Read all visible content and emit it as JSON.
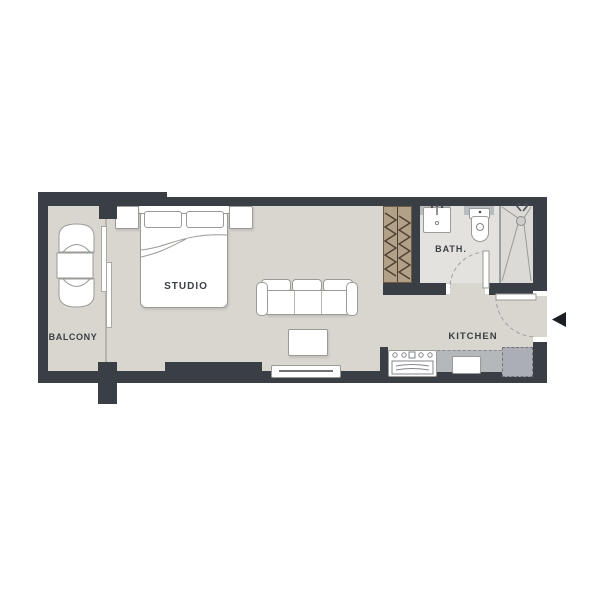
{
  "title": "Studio apartment floor plan",
  "labels": {
    "studio": "STUDIO",
    "balcony": "BALCONY",
    "bath": "BATH.",
    "kitchen": "KITCHEN"
  },
  "entrance": {
    "arrow_direction": "left",
    "side": "right-wall"
  },
  "rooms": [
    {
      "name": "STUDIO",
      "furniture": [
        "double-bed",
        "nightstand-left",
        "nightstand-right",
        "sofa",
        "coffee-table",
        "tv-console",
        "wardrobe"
      ]
    },
    {
      "name": "BALCONY",
      "furniture": [
        "lounge-chair-top",
        "side-table",
        "lounge-chair-bottom",
        "sliding-door"
      ]
    },
    {
      "name": "BATH.",
      "furniture": [
        "vanity-sink",
        "toilet",
        "shower"
      ]
    },
    {
      "name": "KITCHEN",
      "furniture": [
        "range",
        "kitchen-sink",
        "counter",
        "fridge"
      ]
    }
  ],
  "theme": {
    "bg": "#ffffff",
    "wall": "#3a3e45",
    "floor": "#d9d6d0",
    "bath_floor": "#e4e2de",
    "shower_floor": "#dcdad6",
    "wardrobe": "#b2a189",
    "wardrobe_hatch": "#4e4030",
    "counter": "#b5b8bb",
    "fridge": "#abafb5",
    "fixture_gray": "#b9bcc0",
    "outline": "#9a9a97",
    "label_color": "#3a3f46",
    "arrow": "#1b1e22"
  }
}
